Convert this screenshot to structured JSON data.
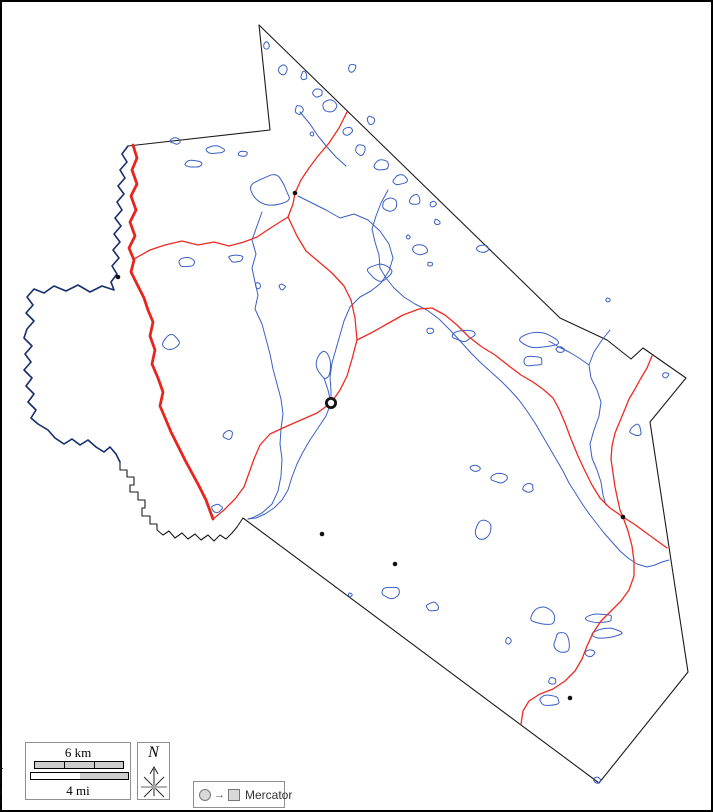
{
  "watermark": {
    "text": "© d-maps.com"
  },
  "scale_bar": {
    "km_label": "6 km",
    "mi_label": "4 mi"
  },
  "compass": {
    "label": "N"
  },
  "projection": {
    "label": "Mercator",
    "arrow": "→"
  },
  "map": {
    "colors": {
      "boundary": "#1a1a1a",
      "water": "#3a5fc4",
      "water_dark": "#16306e",
      "road_major": "#e8251d",
      "road_minor": "#ee2a22",
      "town": "#111111",
      "frame": "#000000"
    },
    "boundary_path": "M259,25 L270,130 L128,146 L122,154 L127,162 L120,170 L125,178 L118,186 L124,194 L117,202 L122,210 L115,218 L121,226 L114,234 L120,242 L113,250 L119,258 L112,266 L117,274 L111,282 L114,290 L102,286 L90,292 L78,285 L66,291 L54,286 L44,293 L34,289 L27,297 L33,305 L26,313 L34,321 L27,329 L24,338 L32,346 L25,354 L31,362 L24,370 L32,378 L26,386 L34,394 L28,402 L36,410 L31,418 L38,424 L48,430 L55,438 L64,444 L72,439 L80,445 L88,440 L96,447 L104,452 L110,447 L116,454 L120,462 L120,470 L127,470 L127,477 L134,477 L134,485 L130,485 L130,492 L138,492 L138,500 L145,500 L145,508 L142,508 L142,516 L150,516 L150,524 L157,524 L157,530 L163,535 L169,531 L175,538 L182,533 L188,539 L195,534 L201,540 L208,535 L214,541 L220,535 L226,539 L232,533 L237,527 L243,518 L599,783 L688,672 L650,422 L686,378 L643,348 L631,359 L607,340 L560,318 Z",
    "west_river_path": "M128,146 L122,154 L127,162 L120,170 L125,178 L118,186 L124,194 L117,202 L122,210 L115,218 L121,226 L114,234 L120,242 L113,250 L119,258 L112,266 L117,274 L111,282 L114,290 L102,286 L90,292 L78,285 L66,291 L54,286 L44,293 L34,289 L27,297 L33,305 L26,313 L34,321 L27,329 L24,338 L32,346 L25,354 L31,362 L24,370 L32,378 L26,386 L34,394 L28,402 L36,410 L31,418 L38,424 L48,430 L55,438 L64,444 L72,439 L80,445 L88,440 L96,447 L104,452 L110,447 L116,454 L120,462",
    "major_road_path": "M133,145 L137,158 L132,170 L137,184 L131,196 L136,210 L130,222 L135,236 L129,248 L134,260 L131,272 L138,286 L144,298 L148,310 L153,322 L150,336 L155,350 L152,364 L158,378 L163,392 L160,406 L166,420 L171,432 L178,446 L185,460 L192,473 L199,486 L206,500 L213,519",
    "minor_roads": [
      "M134,259 L150,250 L165,245 L182,241 L198,245 L214,242 L229,246 L244,242 L257,237 L269,229 L280,222 L288,217",
      "M288,217 L293,204 L295,193 L301,180 L309,168 L318,156 L329,143 L339,128 L347,112",
      "M288,217 L297,236 L306,251 L319,262 L332,273 L344,286 L351,300 L355,318 L357,340",
      "M357,340 L352,359 L347,376 L340,390 L331,403 L317,413 L301,420 L285,427 L270,434 L260,445 L254,459 L249,473 L244,487 L235,499 L224,510 L213,519",
      "M357,340 L371,333 L387,324 L403,315 L419,309 L432,308 L445,315 L457,325 L469,337 L482,347 L495,355 L509,366 L521,375 L533,382 L544,390 L553,398 L559,409 L565,423 L571,439 L578,456 L585,471 L592,485 L600,498 L610,508 L623,517",
      "M652,356 L647,368 L641,378 L635,389 L629,399 L625,409 L620,421 L615,433 L612,446 L611,459 L613,473 L615,487 L618,501 L620,510 L623,517",
      "M623,517 L634,524 L645,532 L656,540 L667,548",
      "M623,517 L628,531 L632,546 L634,561 L634,576 L629,590 L621,601 L611,611 L601,621 L593,633 L587,646 L582,659 L575,671 L565,681 L553,689 L540,694 L529,701 L523,711 L521,724"
    ],
    "rivers": [
      "M262,212 L257,226 L252,240 L256,254 L252,268 L255,282 L258,295 L255,309 L262,324 L266,339 L270,354 L273,369 L277,384 L281,399 L283,414 L281,429 L280,444 L282,459 L281,476 L278,491 L272,504 L262,513 L252,518 L248,519",
      "M298,196 L312,203 L326,210 L340,218 L354,214 L368,220 L380,231 L389,244 L393,258 L389,271 L381,283 L371,291 L360,297 L350,307 L344,321 L340,335 L336,349 L332,363 L330,377 L331,391 L331,403",
      "M331,403 L326,416 L318,428 L310,440 L303,452 L297,464 L292,477 L288,490 L282,500 L274,508 L265,514 L256,518 L248,519",
      "M388,190 L381,203 L376,216 L372,229 L375,242 L379,255 L380,268 L386,278 L394,288 L404,297 L415,304 L427,310 L439,319 L450,330 L461,342 L471,353 L481,363 L491,372 L501,381 L510,390 L519,400 L527,411 L535,423 L542,435 L549,447 L556,459 L563,471 L569,483 L576,494 L583,505 L590,515 L597,524 L604,533 L612,542 L620,551 L628,558 L637,564 L647,567 L655,565 L662,562 L669,560",
      "M610,330 L602,340 L594,352 L589,365 L591,378 L597,390 L601,402 L599,416 L594,430 L590,444 L592,458 L597,470 L601,482 L603,495 L606,505",
      "M589,365 L579,358 L569,352 L559,347 L549,341",
      "M300,112 L310,124 L318,136 L327,147 L336,157 L346,166",
      "M324,378 L328,390 L331,403"
    ],
    "lakes": [
      [
        266,
        46,
        3,
        4
      ],
      [
        283,
        70,
        4,
        6
      ],
      [
        304,
        76,
        3,
        4
      ],
      [
        318,
        93,
        5,
        4
      ],
      [
        299,
        110,
        4,
        5
      ],
      [
        330,
        106,
        7,
        6
      ],
      [
        352,
        68,
        4,
        4
      ],
      [
        312,
        134,
        2,
        2
      ],
      [
        347,
        131,
        5,
        4
      ],
      [
        371,
        120,
        4,
        4
      ],
      [
        360,
        150,
        6,
        5
      ],
      [
        383,
        165,
        8,
        6
      ],
      [
        400,
        180,
        7,
        5
      ],
      [
        390,
        205,
        7,
        8
      ],
      [
        415,
        200,
        6,
        5
      ],
      [
        433,
        204,
        3,
        3
      ],
      [
        437,
        222,
        3,
        3
      ],
      [
        420,
        250,
        8,
        5
      ],
      [
        430,
        264,
        3,
        2
      ],
      [
        408,
        237,
        2,
        2
      ],
      [
        380,
        272,
        12,
        9
      ],
      [
        483,
        248,
        6,
        4
      ],
      [
        176,
        141,
        5,
        3
      ],
      [
        193,
        164,
        8,
        4
      ],
      [
        216,
        150,
        9,
        4
      ],
      [
        243,
        154,
        5,
        3
      ],
      [
        272,
        192,
        20,
        16
      ],
      [
        186,
        262,
        8,
        5
      ],
      [
        236,
        258,
        7,
        4
      ],
      [
        258,
        286,
        3,
        3
      ],
      [
        282,
        287,
        3,
        3
      ],
      [
        171,
        342,
        8,
        7
      ],
      [
        324,
        364,
        7,
        14
      ],
      [
        228,
        435,
        5,
        4
      ],
      [
        217,
        508,
        5,
        4
      ],
      [
        463,
        335,
        12,
        6
      ],
      [
        540,
        341,
        20,
        8
      ],
      [
        533,
        361,
        11,
        5
      ],
      [
        560,
        350,
        4,
        3
      ],
      [
        430,
        331,
        4,
        3
      ],
      [
        666,
        375,
        3,
        3
      ],
      [
        636,
        430,
        6,
        6
      ],
      [
        608,
        300,
        2,
        2
      ],
      [
        483,
        530,
        8,
        9
      ],
      [
        500,
        478,
        9,
        5
      ],
      [
        528,
        488,
        6,
        4
      ],
      [
        475,
        468,
        5,
        3
      ],
      [
        390,
        592,
        10,
        6
      ],
      [
        433,
        607,
        7,
        5
      ],
      [
        350,
        595,
        2,
        2
      ],
      [
        543,
        617,
        11,
        9
      ],
      [
        562,
        643,
        8,
        11
      ],
      [
        600,
        618,
        14,
        5
      ],
      [
        606,
        633,
        15,
        5
      ],
      [
        590,
        653,
        5,
        4
      ],
      [
        552,
        681,
        4,
        3
      ],
      [
        550,
        700,
        11,
        5
      ],
      [
        508,
        641,
        3,
        3
      ],
      [
        597,
        780,
        4,
        3
      ]
    ],
    "towns": [
      {
        "x": 295,
        "y": 193
      },
      {
        "x": 118,
        "y": 277
      },
      {
        "x": 322,
        "y": 534
      },
      {
        "x": 395,
        "y": 564
      },
      {
        "x": 623,
        "y": 517
      },
      {
        "x": 570,
        "y": 698
      }
    ],
    "county_seat": {
      "x": 331,
      "y": 403
    }
  }
}
